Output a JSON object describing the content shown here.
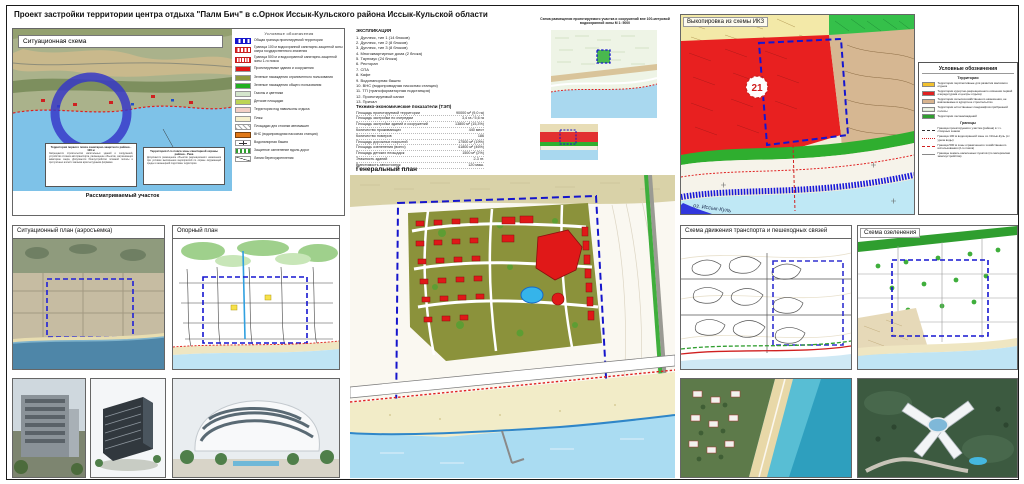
{
  "sheet": {
    "title": "Проект застройки территории центра отдыха \"Палм Бич\" в с.Орнок Иссык-Кульского района Иссык-Кульской области"
  },
  "situational_scheme": {
    "title": "Ситуационная схема",
    "caption": "Рассматриваемый участок",
    "legend_title": "Условные обозначения",
    "legend": [
      {
        "sw": "sw-bluedash",
        "label": "Общая граница проектируемой территории"
      },
      {
        "sw": "sw-reddot",
        "label": "Граница 100 м водоохранной санитарно-защитной зоны озера государственного значения"
      },
      {
        "sw": "sw-reddot2",
        "label": "Граница 500 м и водоохранной санитарно-защитной зоны 1-го пояса"
      },
      {
        "sw": "sw-red",
        "label": "Проектируемые здания и сооружения"
      },
      {
        "sw": "sw-olive",
        "label": "Зеленые насаждения ограниченного пользования"
      },
      {
        "sw": "sw-green",
        "label": "Зеленые насаждения общего пользования"
      },
      {
        "sw": "sw-pale",
        "label": "Газоны и цветники"
      },
      {
        "sw": "sw-lime",
        "label": "Детские площадки"
      },
      {
        "sw": "sw-pink",
        "label": "Территория под павильоны отдыха"
      },
      {
        "sw": "sw-sand",
        "label": "Пляж"
      },
      {
        "sw": "sw-parking",
        "label": "Площадки для стоянки автомашин"
      },
      {
        "sw": "sw-orange",
        "label": "ВНС (водопроводная насосная станция)"
      },
      {
        "sw": "sw-tower",
        "label": "Водонапорная башня"
      },
      {
        "sw": "sw-stripes",
        "label": "Защитное озеленение вдоль дорог"
      },
      {
        "sw": "sw-diag",
        "label": "Линия берегоукрепления"
      }
    ],
    "note_boxes": [
      {
        "title": "Территория первого пояса санитарно-защитного района - 100 м",
        "body": "Запрещается строительство капитальных зданий и сооружений, устройство стоянок автотранспорта, размещение объектов, загрязняющих акваторию озера. Допускается благоустройство пляжной полосы и прогулочных аллей с малыми архитектурными формами."
      },
      {
        "title": "Территория 2-го пояса зоны санитарной охраны района - Река",
        "body": "Допускается размещение объектов рекреационного назначения при условии выполнения мероприятий по охране окружающей среды и инженерной подготовке территории."
      }
    ]
  },
  "explication": {
    "title": "ЭКСПЛИКАЦИЯ",
    "items": [
      "1. Дуплекс, тип 1 (14 блоков)",
      "2. Дуплекс, тип 2 (8 блоков)",
      "3. Дуплекс, тип 3 (8 блоков)",
      "4. Многоквартирные дома (2 блока)",
      "5. Таунхаус (24 блока)",
      "6. Ресторан",
      "7. СПА",
      "8. Кафе",
      "9. Водонапорная башня",
      "10. ВНС (водопроводная насосная станция)",
      "11. ТП (трансформаторная подстанция)",
      "12. Проектируемый канал",
      "13. Причал"
    ]
  },
  "tep": {
    "title": "Технико-экономические показатели (ТЭП)",
    "rows": [
      {
        "label": "Площадь проектируемой территории",
        "value": "90000 м² (9,0 га)"
      },
      {
        "label": "Площадь застройки по очередям",
        "value": "3,4 га / 5,6 га"
      },
      {
        "label": "Площадь застройки зданий и сооружений",
        "value": "13800 м² (15,3%)"
      },
      {
        "label": "Количество проживающих",
        "value": "440 мест"
      },
      {
        "label": "Количество номеров",
        "value": "186"
      },
      {
        "label": "Площадь дорожных покрытий",
        "value": "17500 м² (19%)"
      },
      {
        "label": "Площадь озеленения (всего)",
        "value": "41800 м² (46%)"
      },
      {
        "label": "Площадь детских площадок",
        "value": "1500 м² (2%)"
      },
      {
        "label": "Этажность зданий",
        "value": "2-3 эт."
      },
      {
        "label": "Вместимость автостоянок",
        "value": "120 маш."
      }
    ]
  },
  "genplan": {
    "title": "Генеральный план"
  },
  "placement_scheme": {
    "title": "Схема размещения проектируемого участка и сооружений вне 100-метровой водоохранной зоны М 1: 5000"
  },
  "ikz": {
    "title": "Выкопировка из схемы ИКЗ",
    "badge": "21",
    "lake_label": "оз. Иссык-Куль"
  },
  "ikz_legend": {
    "title": "Условные обозначения",
    "territories_title": "Территории",
    "territories": [
      {
        "sw": "t-yellow",
        "label": "Территории перспективные для развития массового отдыха"
      },
      {
        "sw": "t-red",
        "label": "Территории курортно-рекреационного освоения первой очереди (дома и центры отдыха)"
      },
      {
        "sw": "t-tan",
        "label": "Территории сельскохозяйственного назначения, не вовлекаемые в курортное строительство"
      },
      {
        "sw": "t-pale",
        "label": "Территории естественных ландшафтов прибрежной полосы"
      },
      {
        "sw": "t-green",
        "label": "Территории лесонасаждений"
      }
    ],
    "borders_title": "Границы",
    "borders": [
      {
        "sw": "b-dash",
        "label": "Граница проектируемого участка (района) в т.ч. створных знаков"
      },
      {
        "sw": "b-reddot",
        "label": "Граница 100 м водоохранной зоны оз. Иссык-Куль (от уреза воды)"
      },
      {
        "sw": "b-reddash",
        "label": "Граница 500 м зоны ограниченного хозяйственного использования (2-го пояса)"
      },
      {
        "sw": "b-thin",
        "label": "Границы земель населенных пунктов (по материалам землеустройства)"
      }
    ]
  },
  "panels": {
    "aero": "Ситуационный план (аэросъемка)",
    "oporny": "Опорный план",
    "transport": "Схема движения транспорта и пешеходных связей",
    "greenery": "Схема озеленения"
  }
}
